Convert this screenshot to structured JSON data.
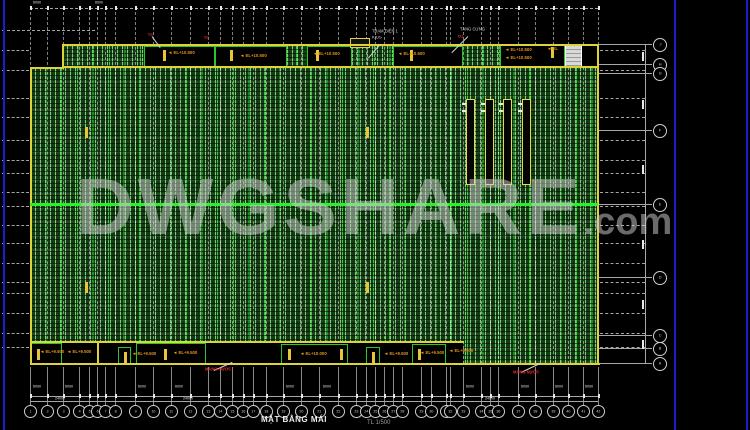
{
  "window": {
    "background": "#000000"
  },
  "watermark": {
    "main": "DWGSHARE",
    "suffix": ".com"
  },
  "title_block": {
    "title": "MẶT BẰNG MÁI",
    "scale": "TL 1/500"
  },
  "colors": {
    "hatch_green": "#123d12",
    "bay_line_green": "#2fd32f",
    "ridge_green": "#2bf12b",
    "edge_yellow": "#ded23a",
    "box_green": "#28c828",
    "label_orange": "#e2921c",
    "label_red": "#e03030",
    "grid_white": "#cfcfcf",
    "frame_blue": "#1d1dd0"
  },
  "annotations": {
    "white_labels": [
      {
        "x": 372,
        "y": 30,
        "text": "TRẠM ĐIỆN 1"
      },
      {
        "x": 372,
        "y": 36,
        "text": "KIOS"
      },
      {
        "x": 460,
        "y": 28,
        "text": "TĂNG CỨNG"
      }
    ],
    "red_labels": [
      {
        "x": 458,
        "y": 35,
        "text": "Đ1"
      },
      {
        "x": 204,
        "y": 36,
        "text": "S1"
      },
      {
        "x": 148,
        "y": 33,
        "text": "S1"
      },
      {
        "x": 513,
        "y": 371,
        "text": "MÁNG NƯỚC"
      },
      {
        "x": 205,
        "y": 368,
        "text": "MÁNG NƯỚC"
      }
    ],
    "orange_top_labels": [
      {
        "x": 168,
        "y": 51,
        "text": "EL+10.500"
      },
      {
        "x": 240,
        "y": 54,
        "text": "EL+10.500"
      },
      {
        "x": 313,
        "y": 52,
        "text": "EL+10.500"
      },
      {
        "x": 398,
        "y": 52,
        "text": "EL+10.500"
      },
      {
        "x": 505,
        "y": 48,
        "text": "EL+10.500"
      },
      {
        "x": 505,
        "y": 56,
        "text": "EL+10.500"
      },
      {
        "x": 547,
        "y": 47,
        "text": "EL"
      }
    ],
    "orange_bottom_labels": [
      {
        "x": 40,
        "y": 350,
        "text": "EL+9.500"
      },
      {
        "x": 67,
        "y": 350,
        "text": "EL+9.500"
      },
      {
        "x": 132,
        "y": 352,
        "text": "EL+9.500"
      },
      {
        "x": 173,
        "y": 351,
        "text": "EL+9.500"
      },
      {
        "x": 300,
        "y": 352,
        "text": "EL+10.000"
      },
      {
        "x": 384,
        "y": 352,
        "text": "EL+9.500"
      },
      {
        "x": 420,
        "y": 351,
        "text": "EL+9.500"
      },
      {
        "x": 449,
        "y": 349,
        "text": "EL+9.500"
      }
    ]
  },
  "axes": {
    "bottom_bubbles": [
      {
        "x": 30,
        "label": "1"
      },
      {
        "x": 47,
        "label": "2"
      },
      {
        "x": 63,
        "label": "3"
      },
      {
        "x": 79,
        "label": "4"
      },
      {
        "x": 89,
        "label": "5"
      },
      {
        "x": 97,
        "label": "6"
      },
      {
        "x": 105,
        "label": "7"
      },
      {
        "x": 115,
        "label": "8"
      },
      {
        "x": 135,
        "label": "9"
      },
      {
        "x": 153,
        "label": "10"
      },
      {
        "x": 171,
        "label": "11"
      },
      {
        "x": 190,
        "label": "12"
      },
      {
        "x": 208,
        "label": "13"
      },
      {
        "x": 220,
        "label": "14"
      },
      {
        "x": 232,
        "label": "15"
      },
      {
        "x": 243,
        "label": "16"
      },
      {
        "x": 253,
        "label": "17"
      },
      {
        "x": 266,
        "label": "18"
      },
      {
        "x": 283,
        "label": "19"
      },
      {
        "x": 301,
        "label": "20"
      },
      {
        "x": 319,
        "label": "21"
      },
      {
        "x": 338,
        "label": "22"
      },
      {
        "x": 356,
        "label": "23"
      },
      {
        "x": 366,
        "label": "24"
      },
      {
        "x": 375,
        "label": "25"
      },
      {
        "x": 384,
        "label": "26"
      },
      {
        "x": 393,
        "label": "27"
      },
      {
        "x": 402,
        "label": "28"
      },
      {
        "x": 421,
        "label": "29"
      },
      {
        "x": 431,
        "label": "30"
      },
      {
        "x": 446,
        "label": "31"
      },
      {
        "x": 450,
        "label": "32"
      },
      {
        "x": 463,
        "label": "33"
      },
      {
        "x": 481,
        "label": "34"
      },
      {
        "x": 490,
        "label": "35"
      },
      {
        "x": 498,
        "label": "36"
      },
      {
        "x": 518,
        "label": "37"
      },
      {
        "x": 535,
        "label": "38"
      },
      {
        "x": 553,
        "label": "39"
      },
      {
        "x": 568,
        "label": "40"
      },
      {
        "x": 583,
        "label": "41"
      },
      {
        "x": 598,
        "label": "42"
      }
    ],
    "right_bubbles": [
      {
        "y": 44,
        "label": "J"
      },
      {
        "y": 64,
        "label": "H"
      },
      {
        "y": 73,
        "label": "G"
      },
      {
        "y": 130,
        "label": "F"
      },
      {
        "y": 204,
        "label": "E"
      },
      {
        "y": 277,
        "label": "D"
      },
      {
        "y": 335,
        "label": "C"
      },
      {
        "y": 348,
        "label": "B"
      },
      {
        "y": 363,
        "label": "A"
      }
    ],
    "purlin_ys": [
      50,
      70,
      98,
      117,
      140,
      160,
      173,
      192,
      206,
      225,
      243,
      263,
      282,
      293,
      313,
      333,
      347
    ],
    "top_dims": [
      {
        "x": 33,
        "text": "6000"
      },
      {
        "x": 95,
        "text": "6000"
      }
    ],
    "bay_dim_label": "6000",
    "row2_dims": [
      {
        "x": 55,
        "text": "24000"
      },
      {
        "x": 183,
        "text": "24000"
      },
      {
        "x": 485,
        "text": "24000"
      }
    ]
  },
  "drawing": {
    "hatch_main": {
      "x": 30,
      "y": 67,
      "w": 568,
      "h": 297
    },
    "hatch_top": {
      "x": 62,
      "y": 45,
      "w": 536,
      "h": 23
    },
    "black_overlays": [
      {
        "x": 30,
        "y": 342,
        "w": 433,
        "h": 22
      },
      {
        "x": 582,
        "y": 45,
        "w": 16,
        "h": 22
      }
    ],
    "top_boxes": [
      {
        "x": 144,
        "y": 46,
        "w": 71,
        "h": 21
      },
      {
        "x": 215,
        "y": 46,
        "w": 72,
        "h": 21
      },
      {
        "x": 307,
        "y": 46,
        "w": 45,
        "h": 21
      },
      {
        "x": 393,
        "y": 46,
        "w": 70,
        "h": 21
      },
      {
        "x": 500,
        "y": 45,
        "w": 65,
        "h": 22
      }
    ],
    "bottom_boxes": [
      {
        "x": 31,
        "y": 343,
        "w": 31,
        "h": 21
      },
      {
        "x": 118,
        "y": 347,
        "w": 13,
        "h": 17
      },
      {
        "x": 136,
        "y": 343,
        "w": 70,
        "h": 21
      },
      {
        "x": 281,
        "y": 344,
        "w": 67,
        "h": 21
      },
      {
        "x": 366,
        "y": 347,
        "w": 14,
        "h": 17
      },
      {
        "x": 412,
        "y": 344,
        "w": 34,
        "h": 21
      }
    ],
    "yellow_ticks": [
      {
        "x": 163,
        "y": 50
      },
      {
        "x": 230,
        "y": 50
      },
      {
        "x": 316,
        "y": 50
      },
      {
        "x": 410,
        "y": 50
      },
      {
        "x": 551,
        "y": 47
      },
      {
        "x": 37,
        "y": 349
      },
      {
        "x": 124,
        "y": 352
      },
      {
        "x": 164,
        "y": 349
      },
      {
        "x": 288,
        "y": 349
      },
      {
        "x": 340,
        "y": 349
      },
      {
        "x": 372,
        "y": 352
      },
      {
        "x": 418,
        "y": 349
      },
      {
        "x": 85,
        "y": 127
      },
      {
        "x": 366,
        "y": 127
      },
      {
        "x": 85,
        "y": 282
      },
      {
        "x": 366,
        "y": 282
      }
    ],
    "mini_box": {
      "x": 350,
      "y": 38,
      "w": 18,
      "h": 8
    },
    "white_panel": {
      "x": 565,
      "y": 44,
      "w": 17,
      "h": 23
    },
    "edges": [
      {
        "x": 62,
        "y": 44,
        "w": 536,
        "h": 2
      },
      {
        "x": 62,
        "y": 44,
        "w": 2,
        "h": 24
      },
      {
        "x": 30,
        "y": 67,
        "w": 34,
        "h": 2
      },
      {
        "x": 30,
        "y": 67,
        "w": 2,
        "h": 298
      },
      {
        "x": 30,
        "y": 363,
        "w": 570,
        "h": 2
      },
      {
        "x": 597,
        "y": 44,
        "w": 2,
        "h": 321
      },
      {
        "x": 62,
        "y": 66,
        "w": 536,
        "h": 1.5
      },
      {
        "x": 30,
        "y": 341,
        "w": 434,
        "h": 1.5
      },
      {
        "x": 97,
        "y": 342,
        "w": 1.5,
        "h": 22
      }
    ],
    "ridge_line": {
      "x": 30,
      "y": 203,
      "w": 568,
      "h": 3
    },
    "smoke_bars": {
      "xs": [
        466,
        485,
        503,
        522
      ],
      "y": 99,
      "h": 86,
      "w": 9
    },
    "leaders": [
      {
        "x1": 380,
        "y1": 44,
        "x2": 368,
        "y2": 58
      },
      {
        "x1": 468,
        "y1": 36,
        "x2": 452,
        "y2": 52
      },
      {
        "x1": 152,
        "y1": 36,
        "x2": 160,
        "y2": 47
      },
      {
        "x1": 214,
        "y1": 370,
        "x2": 232,
        "y2": 362
      },
      {
        "x1": 521,
        "y1": 372,
        "x2": 540,
        "y2": 363
      }
    ],
    "right_dim_marks_y": [
      52,
      100,
      165,
      240,
      300,
      340
    ],
    "blue_lines_x": [
      3,
      674,
      746
    ]
  }
}
